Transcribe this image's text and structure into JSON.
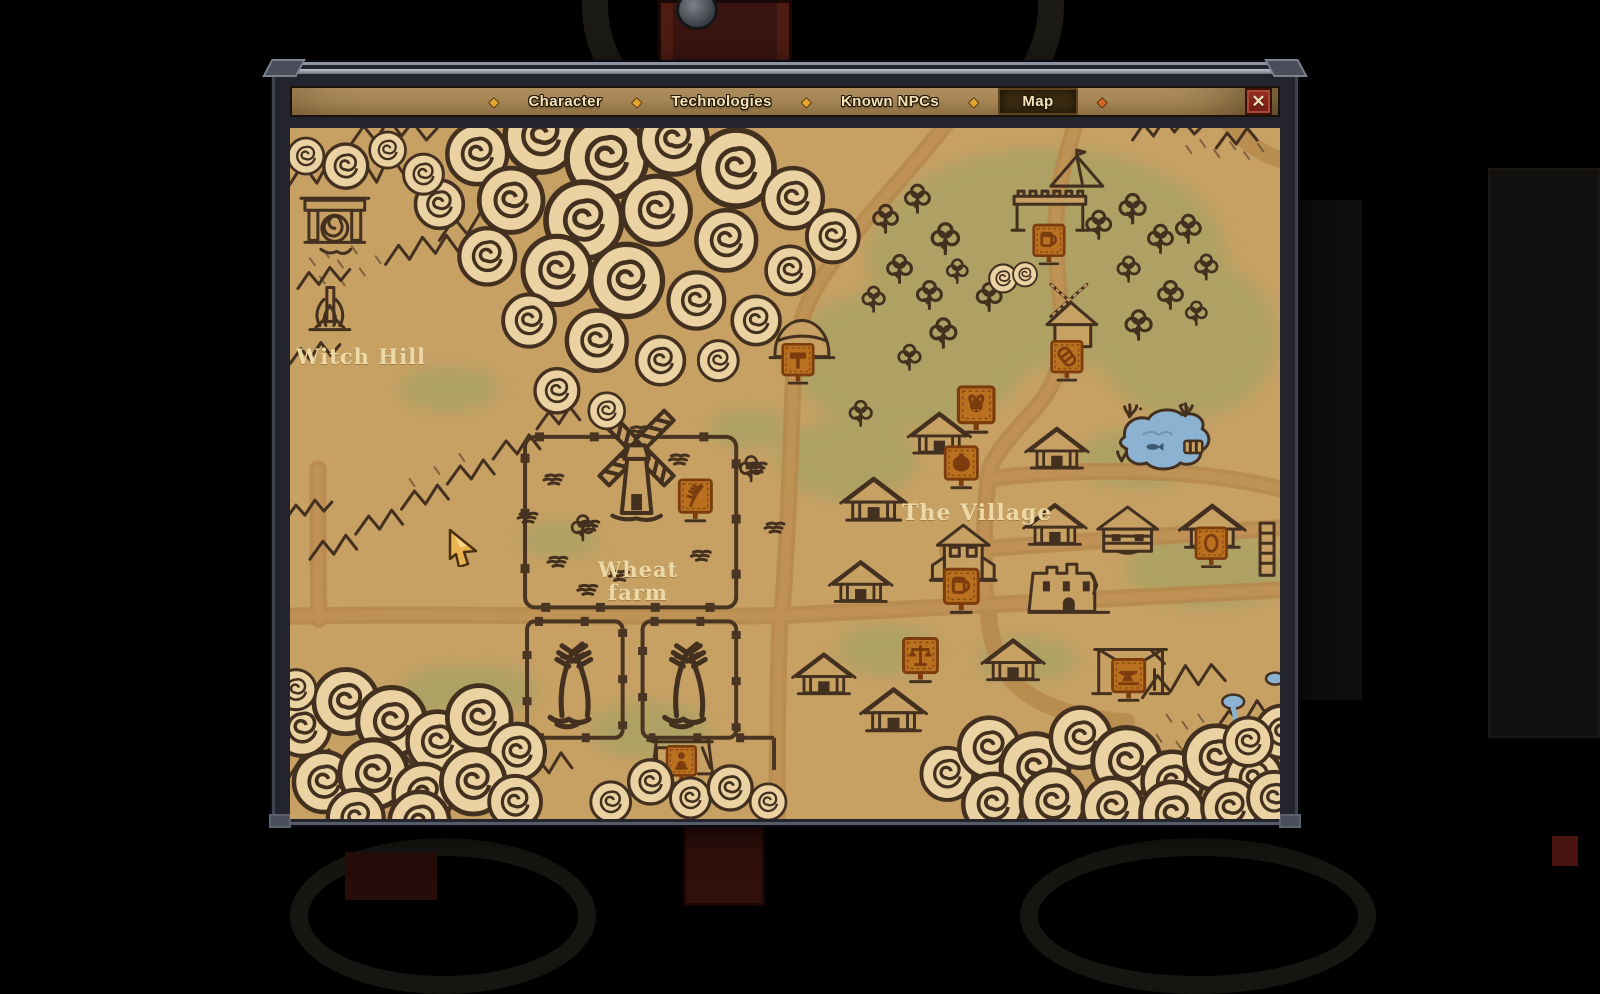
{
  "app": {
    "name": "game-map-screen"
  },
  "tab_bar": {
    "tabs": [
      {
        "id": "character",
        "label": "Character",
        "selected": false
      },
      {
        "id": "technologies",
        "label": "Technologies",
        "selected": false
      },
      {
        "id": "known-npcs",
        "label": "Known NPCs",
        "selected": false
      },
      {
        "id": "map",
        "label": "Map",
        "selected": true
      }
    ],
    "separator_glyph": "◆",
    "close_glyph": "✕"
  },
  "map": {
    "location_labels": {
      "witch_hill": "Witch Hill",
      "wheat_farm_line1": "Wheat",
      "wheat_farm_line2": "farm",
      "the_village": "The Village"
    },
    "markers": [
      {
        "name": "witch-hill-gate",
        "symbol": "gate",
        "x": 45,
        "y": 96,
        "scale": 1
      },
      {
        "name": "witch-hill-campfire",
        "symbol": "campfire",
        "x": 40,
        "y": 185,
        "scale": 1
      },
      {
        "name": "forest-camp-tent",
        "symbol": "tent",
        "x": 790,
        "y": 44,
        "scale": 1
      },
      {
        "name": "forest-camp-wall",
        "symbol": "wall",
        "x": 763,
        "y": 78,
        "scale": 1
      },
      {
        "name": "forest-camp-sign-mug",
        "symbol": "sign-mug",
        "x": 762,
        "y": 112,
        "scale": 0.9
      },
      {
        "name": "hilltop-hut",
        "symbol": "hut",
        "x": 514,
        "y": 212,
        "scale": 1
      },
      {
        "name": "hilltop-sign-hammer",
        "symbol": "sign-hammer",
        "x": 510,
        "y": 231,
        "scale": 0.9
      },
      {
        "name": "miller-windmill-house",
        "symbol": "windmill-house",
        "x": 788,
        "y": 198,
        "scale": 1
      },
      {
        "name": "miller-sign-barrel",
        "symbol": "sign-barrel",
        "x": 780,
        "y": 228,
        "scale": 0.9
      },
      {
        "name": "farm-windmill",
        "symbol": "windmill",
        "x": 348,
        "y": 338,
        "scale": 1.35
      },
      {
        "name": "farm-sign-wheat",
        "symbol": "sign-wheat",
        "x": 407,
        "y": 367,
        "scale": 0.95
      },
      {
        "name": "village-house-1",
        "symbol": "house",
        "x": 652,
        "y": 307,
        "scale": 0.95
      },
      {
        "name": "butcher-sign-bull",
        "symbol": "sign-bull",
        "x": 689,
        "y": 276,
        "scale": 1.05
      },
      {
        "name": "potter-sign-jug",
        "symbol": "sign-jug",
        "x": 674,
        "y": 334,
        "scale": 0.95
      },
      {
        "name": "village-house-2",
        "symbol": "house",
        "x": 770,
        "y": 322,
        "scale": 0.95
      },
      {
        "name": "village-house-3",
        "symbol": "house",
        "x": 586,
        "y": 373,
        "scale": 1
      },
      {
        "name": "village-house-4",
        "symbol": "house",
        "x": 573,
        "y": 455,
        "scale": 0.95
      },
      {
        "name": "tavern-house",
        "symbol": "house-tall",
        "x": 676,
        "y": 430,
        "scale": 1
      },
      {
        "name": "tavern-sign-mug",
        "symbol": "sign-mug",
        "x": 674,
        "y": 457,
        "scale": 1
      },
      {
        "name": "village-house-5",
        "symbol": "house",
        "x": 768,
        "y": 398,
        "scale": 0.95
      },
      {
        "name": "village-log-house",
        "symbol": "log-house",
        "x": 841,
        "y": 404,
        "scale": 1
      },
      {
        "name": "village-house-6",
        "symbol": "house",
        "x": 926,
        "y": 400,
        "scale": 1
      },
      {
        "name": "chandler-sign-egg",
        "symbol": "sign-egg",
        "x": 925,
        "y": 414,
        "scale": 0.9
      },
      {
        "name": "village-church-ruin",
        "symbol": "church",
        "x": 782,
        "y": 464,
        "scale": 1
      },
      {
        "name": "village-house-7",
        "symbol": "house",
        "x": 536,
        "y": 547,
        "scale": 0.95
      },
      {
        "name": "village-house-8",
        "symbol": "house",
        "x": 606,
        "y": 583,
        "scale": 1
      },
      {
        "name": "village-house-9",
        "symbol": "house",
        "x": 726,
        "y": 533,
        "scale": 0.95
      },
      {
        "name": "market-sign-scales",
        "symbol": "sign-scales",
        "x": 633,
        "y": 526,
        "scale": 1
      },
      {
        "name": "smithy-frame",
        "symbol": "frame",
        "x": 844,
        "y": 540,
        "scale": 1
      },
      {
        "name": "smithy-sign-anvil",
        "symbol": "sign-anvil",
        "x": 842,
        "y": 546,
        "scale": 0.95
      },
      {
        "name": "watchtower-ladder",
        "symbol": "tower",
        "x": 981,
        "y": 420,
        "scale": 1
      },
      {
        "name": "farm-shed",
        "symbol": "shed",
        "x": 394,
        "y": 626,
        "scale": 1
      },
      {
        "name": "farm-sign-person",
        "symbol": "sign-person",
        "x": 393,
        "y": 631,
        "scale": 0.85
      }
    ]
  },
  "cursor": {
    "x": 447,
    "y": 527
  },
  "colors": {
    "map_background": "#c7a064",
    "map_outline": "#44301f",
    "sign_board": "#b9701f",
    "cloud_fill": "#ead2a2",
    "grass": "#a6a263",
    "road": "#b7894e",
    "water": "#8cb2d1",
    "label_text": "#ecd9a6",
    "tab_text": "#f2e2b8",
    "tab_selected_bg": "#3a2a10",
    "diamond_gold": "#e6a42f",
    "diamond_orange": "#d2641e",
    "close_bg": "#8a251c"
  }
}
